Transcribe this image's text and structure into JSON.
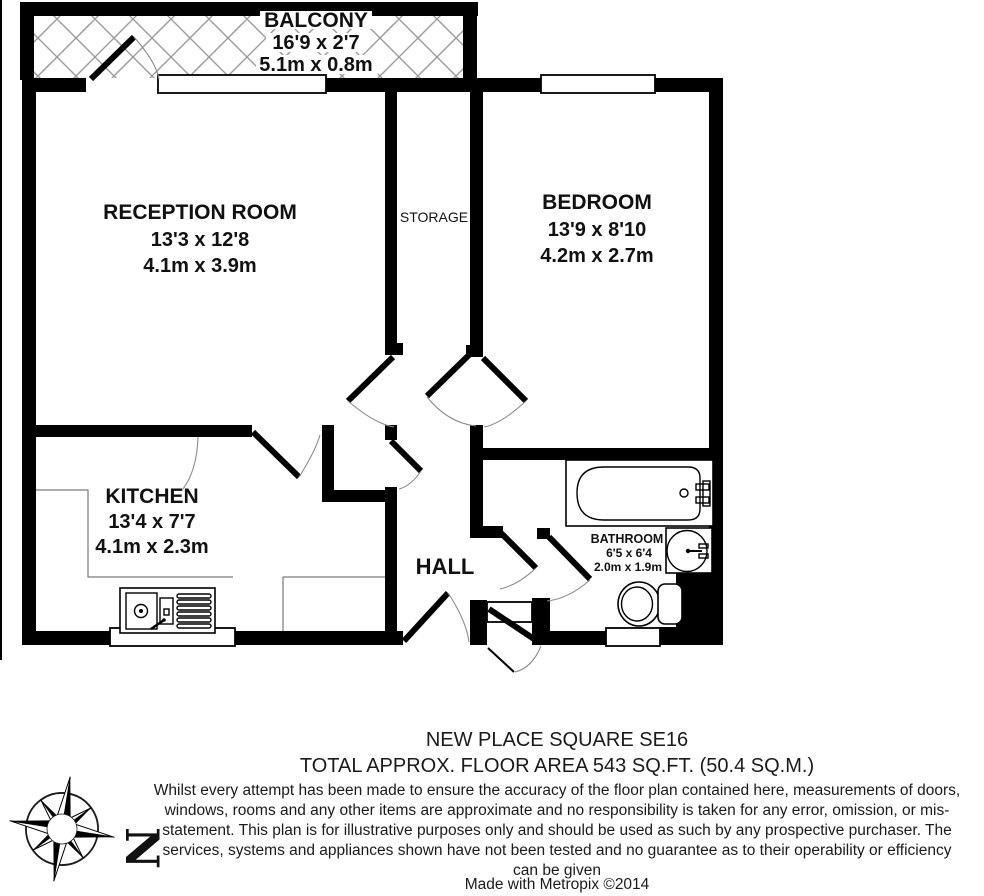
{
  "plan": {
    "balcony": {
      "name": "BALCONY",
      "imperial": "16'9 x 2'7",
      "metric": "5.1m x 0.8m"
    },
    "reception": {
      "name": "RECEPTION ROOM",
      "imperial": "13'3 x 12'8",
      "metric": "4.1m x 3.9m"
    },
    "storage": {
      "name": "STORAGE"
    },
    "bedroom": {
      "name": "BEDROOM",
      "imperial": "13'9 x 8'10",
      "metric": "4.2m x 2.7m"
    },
    "kitchen": {
      "name": "KITCHEN",
      "imperial": "13'4 x 7'7",
      "metric": "4.1m x 2.3m"
    },
    "hall": {
      "name": "HALL"
    },
    "bathroom": {
      "name": "BATHROOM",
      "imperial": "6'5 x 6'4",
      "metric": "2.0m x 1.9m"
    }
  },
  "compass": {
    "north_label": "N"
  },
  "footer": {
    "address": "NEW PLACE SQUARE SE16",
    "area": "TOTAL APPROX. FLOOR AREA 543 SQ.FT. (50.4 SQ.M.)",
    "disclaimer": "Whilst every attempt has been made to ensure the accuracy of the floor plan contained here, measurements of doors, windows, rooms and any other items are approximate and no responsibility is taken for any error, omission, or mis-statement. This plan is for illustrative purposes only and should be used as such by any prospective purchaser. The services, systems and appliances shown have not been tested and no guarantee as to their operability or efficiency can be given",
    "credit": "Made with Metropix ©2014"
  },
  "colors": {
    "wall": "#000000",
    "hatch": "#9a9a9a",
    "door_arc": "#8a8a8a"
  }
}
